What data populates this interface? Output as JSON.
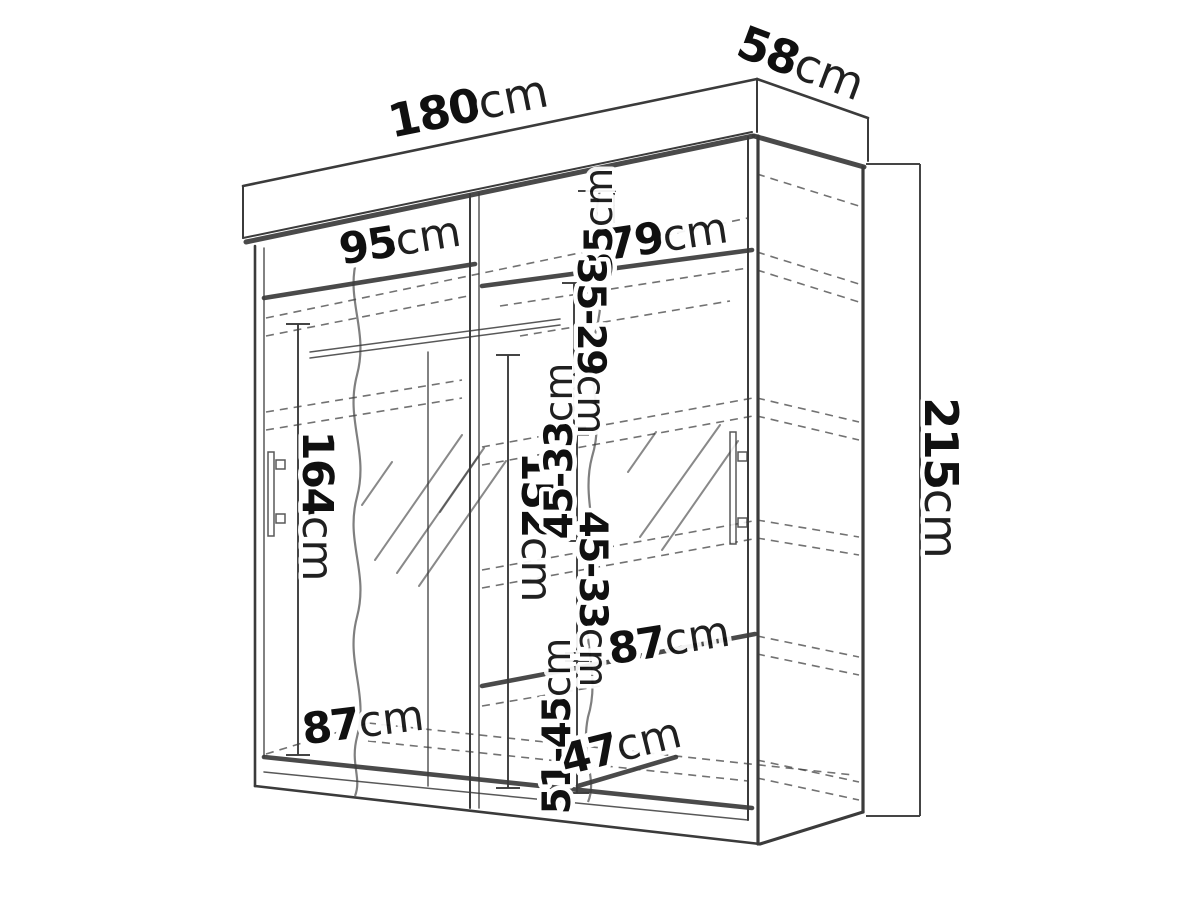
{
  "diagram": {
    "kind": "wardrobe technical line drawing with dimensions",
    "palette": {
      "background": "#ffffff",
      "ink": "#3b3b3b",
      "text": "#101010",
      "halo": "#ffffff"
    },
    "labels": {
      "overall_width": "180cm",
      "overall_depth": "58cm",
      "overall_height": "215cm",
      "top_shelf_left": "95cm",
      "top_shelf_right": "79cm",
      "hanging_height_left": "164cm",
      "mirror_height": "152cm",
      "top_gap_right": "35cm",
      "gap_35_29": "35-29cm",
      "gap_45_33_upper": "45-33cm",
      "gap_45_33_lower": "45-33cm",
      "shelf_width_right": "87cm",
      "gap_51_45": "51-45cm",
      "shelf_width_bottom_left": "87cm",
      "bottom_shelf_depth": "47cm"
    }
  }
}
